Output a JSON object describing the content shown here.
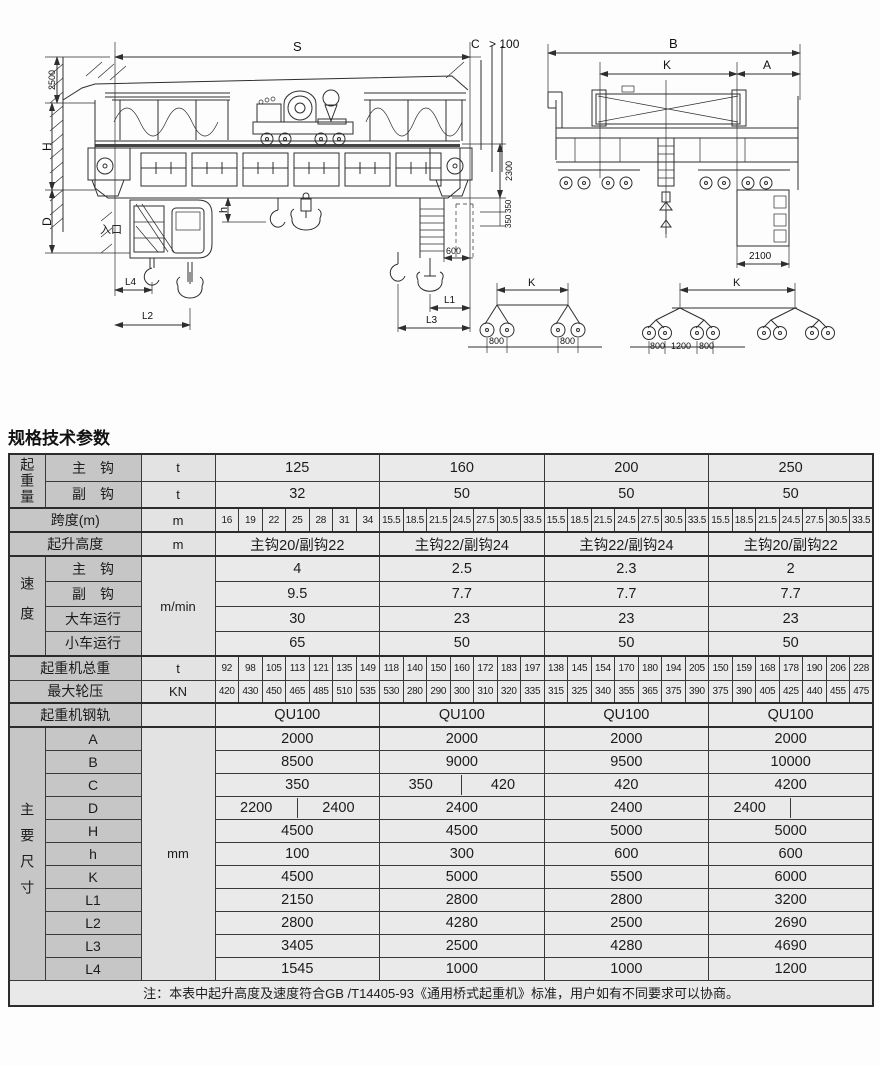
{
  "page": {
    "section_title": "规格技术参数",
    "note": "注：本表中起升高度及速度符合GB /T14405-93《通用桥式起重机》标准，用户如有不同要求可以协商。"
  },
  "drawing": {
    "front_view_labels": {
      "s": "S",
      "c": "C",
      "clearance": "> 100",
      "h2500": "2500",
      "h_dim": "H",
      "d_dim": "D",
      "entrance": "入口",
      "h_small": "h",
      "v2300": "2300",
      "v350a": "350",
      "v350b": "350",
      "w600": "600",
      "l1": "L1",
      "l2": "L2",
      "l3": "L3",
      "l4": "L4"
    },
    "end_view_labels": {
      "b": "B",
      "k": "K",
      "a": "A",
      "w2100": "2100"
    },
    "wheelbase_left": {
      "k": "K",
      "g1": "800",
      "g2": "800"
    },
    "wheelbase_right": {
      "k": "K",
      "g1": "800",
      "g2": "1200",
      "g3": "800"
    }
  },
  "table": {
    "lifting": {
      "group": "起重量",
      "rows": [
        {
          "label": "主　钩",
          "unit": "t",
          "values": [
            "125",
            "160",
            "200",
            "250"
          ]
        },
        {
          "label": "副　钩",
          "unit": "t",
          "values": [
            "32",
            "50",
            "50",
            "50"
          ]
        }
      ]
    },
    "span": {
      "label": "跨度(m)",
      "unit": "m",
      "values": [
        [
          "16",
          "19",
          "22",
          "25",
          "28",
          "31",
          "34"
        ],
        [
          "15.5",
          "18.5",
          "21.5",
          "24.5",
          "27.5",
          "30.5",
          "33.5"
        ],
        [
          "15.5",
          "18.5",
          "21.5",
          "24.5",
          "27.5",
          "30.5",
          "33.5"
        ],
        [
          "15.5",
          "18.5",
          "21.5",
          "24.5",
          "27.5",
          "30.5",
          "33.5"
        ]
      ]
    },
    "height": {
      "label": "起升高度",
      "unit": "m",
      "values": [
        "主钩20/副钩22",
        "主钩22/副钩24",
        "主钩22/副钩24",
        "主钩20/副钩22"
      ]
    },
    "speed": {
      "group": "速度",
      "unit": "m/min",
      "rows": [
        {
          "label": "主　钩",
          "values": [
            "4",
            "2.5",
            "2.3",
            "2"
          ]
        },
        {
          "label": "副　钩",
          "values": [
            "9.5",
            "7.7",
            "7.7",
            "7.7"
          ]
        },
        {
          "label": "大车运行",
          "values": [
            "30",
            "23",
            "23",
            "23"
          ]
        },
        {
          "label": "小车运行",
          "values": [
            "65",
            "50",
            "50",
            "50"
          ]
        }
      ]
    },
    "total_weight": {
      "label": "起重机总重",
      "unit": "t",
      "values": [
        [
          "92",
          "98",
          "105",
          "113",
          "121",
          "135",
          "149"
        ],
        [
          "118",
          "140",
          "150",
          "160",
          "172",
          "183",
          "197"
        ],
        [
          "138",
          "145",
          "154",
          "170",
          "180",
          "194",
          "205"
        ],
        [
          "150",
          "159",
          "168",
          "178",
          "190",
          "206",
          "228"
        ]
      ]
    },
    "max_wheel_load": {
      "label": "最大轮压",
      "unit": "KN",
      "values": [
        [
          "420",
          "430",
          "450",
          "465",
          "485",
          "510",
          "535"
        ],
        [
          "530",
          "280",
          "290",
          "300",
          "310",
          "320",
          "335"
        ],
        [
          "315",
          "325",
          "340",
          "355",
          "365",
          "375",
          "390"
        ],
        [
          "375",
          "390",
          "405",
          "425",
          "440",
          "455",
          "475"
        ]
      ]
    },
    "rail": {
      "label": "起重机钢轨",
      "unit": "",
      "values": [
        "QU100",
        "QU100",
        "QU100",
        "QU100"
      ]
    },
    "dimensions": {
      "group": "主要尺寸",
      "unit": "mm",
      "rows": [
        {
          "label": "A",
          "values": [
            "2000",
            "2000",
            "2000",
            "2000"
          ]
        },
        {
          "label": "B",
          "values": [
            "8500",
            "9000",
            "9500",
            "10000"
          ]
        },
        {
          "label": "C",
          "values": [
            "350",
            [
              "350",
              "420"
            ],
            "420",
            "4200"
          ]
        },
        {
          "label": "D",
          "values": [
            [
              "2200",
              "2400"
            ],
            "2400",
            "2400",
            [
              "2400",
              ""
            ]
          ]
        },
        {
          "label": "H",
          "values": [
            "4500",
            "4500",
            "5000",
            "5000"
          ]
        },
        {
          "label": "h",
          "values": [
            "100",
            "300",
            "600",
            "600"
          ]
        },
        {
          "label": "K",
          "values": [
            "4500",
            "5000",
            "5500",
            "6000"
          ]
        },
        {
          "label": "L1",
          "values": [
            "2150",
            "2800",
            "2800",
            "3200"
          ]
        },
        {
          "label": "L2",
          "values": [
            "2800",
            "4280",
            "2500",
            "2690"
          ]
        },
        {
          "label": "L3",
          "values": [
            "3405",
            "2500",
            "4280",
            "4690"
          ]
        },
        {
          "label": "L4",
          "values": [
            "1545",
            "1000",
            "1000",
            "1200"
          ]
        }
      ]
    }
  }
}
